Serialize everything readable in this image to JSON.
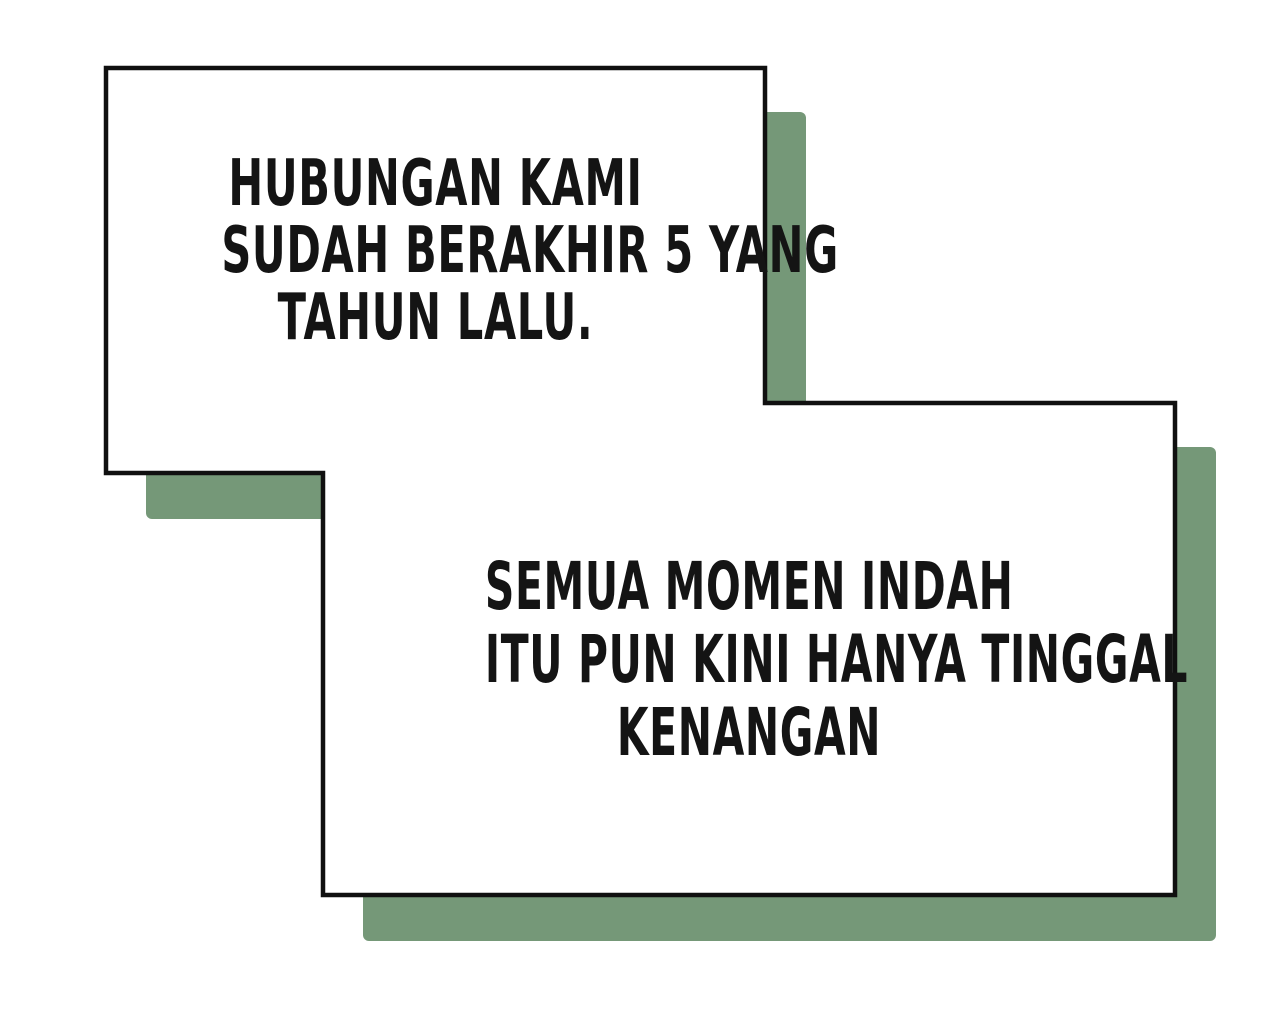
{
  "theme": {
    "page_bg": "#ffffff",
    "panel_fill": "#ffffff",
    "panel_border": "#101010",
    "shadow_color": "#759878",
    "text_color": "#141414"
  },
  "captions": [
    {
      "panel": "top-left",
      "lines": [
        "HUBUNGAN KAMI",
        "SUDAH BERAKHIR 5 YANG",
        "TAHUN LALU."
      ]
    },
    {
      "panel": "bottom-right",
      "lines": [
        "SEMUA MOMEN INDAH",
        "ITU PUN KINI HANYA TINGGAL",
        "KENANGAN"
      ]
    }
  ]
}
